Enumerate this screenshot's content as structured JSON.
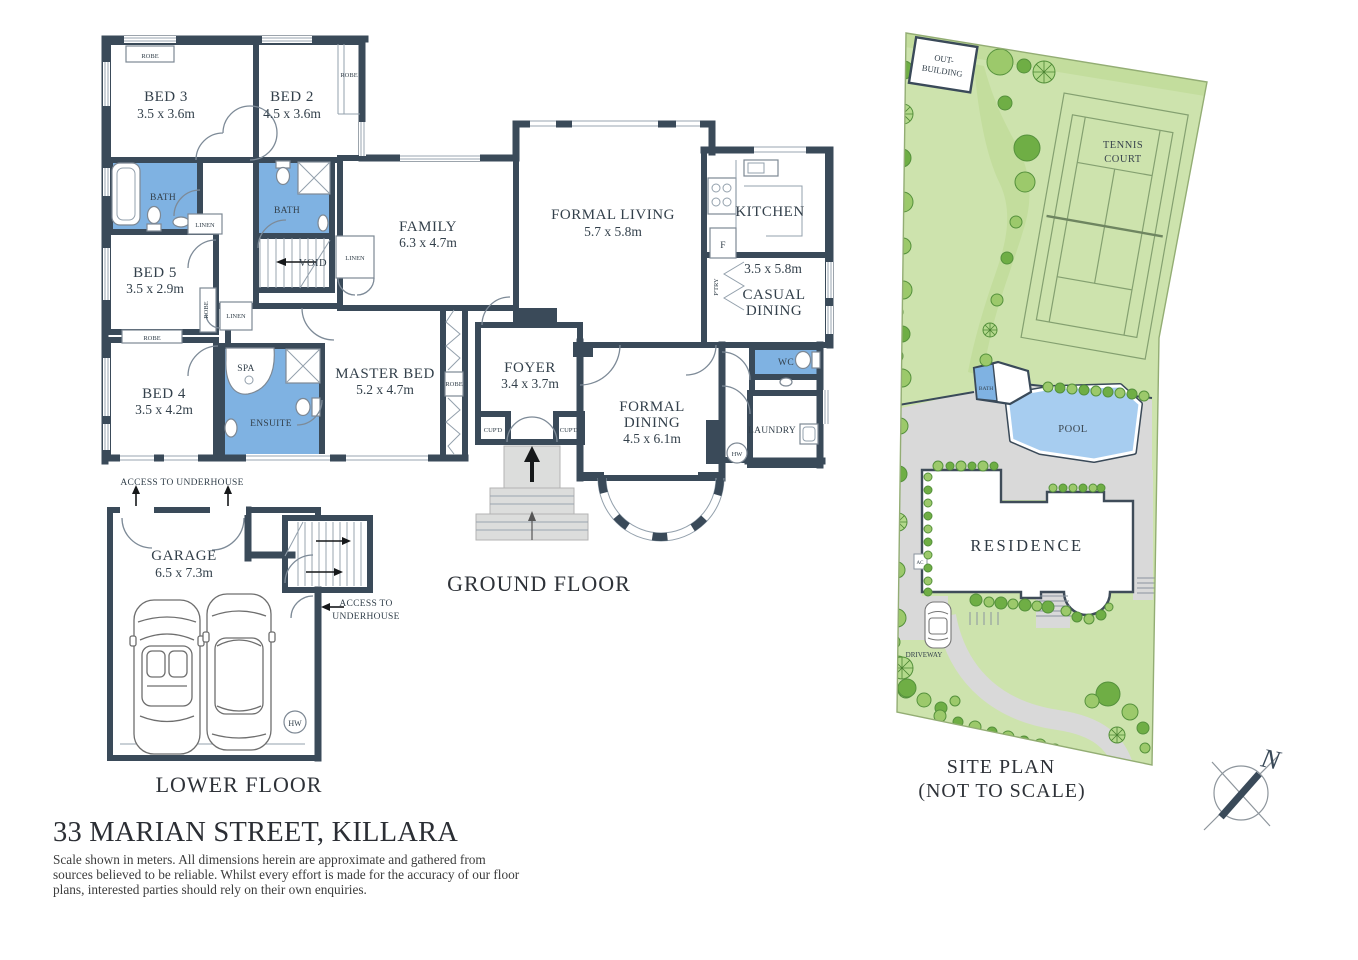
{
  "colors": {
    "wall": "#3a4a59",
    "bath": "#7fb2e2",
    "lawn": "#cde3ad",
    "path": "#d9d9d9",
    "pool": "#a7cdf0",
    "tree": "#9cc96b",
    "treedark": "#6fae45",
    "ink": "#33404b"
  },
  "title": "33 MARIAN STREET, KILLARA",
  "disclaimer": {
    "line1": "Scale shown in meters. All dimensions herein are approximate and gathered from",
    "line2": "sources believed to be  reliable. Whilst every effort is made for the accuracy of our floor",
    "line3": "plans, interested parties should rely on their own enquiries."
  },
  "floors": {
    "ground": {
      "label": "GROUND FLOOR"
    },
    "lower": {
      "label": "LOWER FLOOR"
    }
  },
  "rooms": {
    "bed3": {
      "name": "BED 3",
      "dims": "3.5 x 3.6m"
    },
    "bed2": {
      "name": "BED 2",
      "dims": "4.5 x 3.6m"
    },
    "bed5": {
      "name": "BED 5",
      "dims": "3.5 x 2.9m"
    },
    "bed4": {
      "name": "BED 4",
      "dims": "3.5 x 4.2m"
    },
    "master": {
      "name": "MASTER BED",
      "dims": "5.2 x 4.7m"
    },
    "family": {
      "name": "FAMILY",
      "dims": "6.3 x 4.7m"
    },
    "formal_living": {
      "name": "FORMAL LIVING",
      "dims": "5.7 x 5.8m"
    },
    "formal_dining": {
      "l1": "FORMAL",
      "l2": "DINING",
      "dims": "4.5 x 6.1m"
    },
    "casual_dining": {
      "l1": "CASUAL",
      "l2": "DINING",
      "dims": "3.5 x 5.8m"
    },
    "kitchen": {
      "name": "KITCHEN"
    },
    "foyer": {
      "name": "FOYER",
      "dims": "3.4 x 3.7m"
    },
    "garage": {
      "name": "GARAGE",
      "dims": "6.5 x 7.3m"
    },
    "bath": {
      "name": "BATH"
    },
    "ensuite": {
      "name": "ENSUITE"
    },
    "spa": {
      "name": "SPA"
    },
    "wc": {
      "name": "WC"
    },
    "laundry": {
      "name": "LAUNDRY"
    },
    "void": {
      "name": "VOID"
    }
  },
  "fixtures": {
    "robe": "ROBE",
    "linen": "LINEN",
    "cupd": "CUP'D",
    "pantry": "P'TRY",
    "fridge": "F",
    "hw": "HW",
    "access_line": "ACCESS TO UNDERHOUSE",
    "access_l1": "ACCESS TO",
    "access_l2": "UNDERHOUSE"
  },
  "site": {
    "title_l1": "SITE PLAN",
    "title_l2": "(NOT TO SCALE)",
    "outbuilding_l1": "OUT-",
    "outbuilding_l2": "BUILDING",
    "tennis_l1": "TENNIS",
    "tennis_l2": "COURT",
    "pool": "POOL",
    "bath": "BATH",
    "residence": "RESIDENCE",
    "driveway": "DRIVEWAY",
    "ac": "AC",
    "compass_n": "N"
  }
}
